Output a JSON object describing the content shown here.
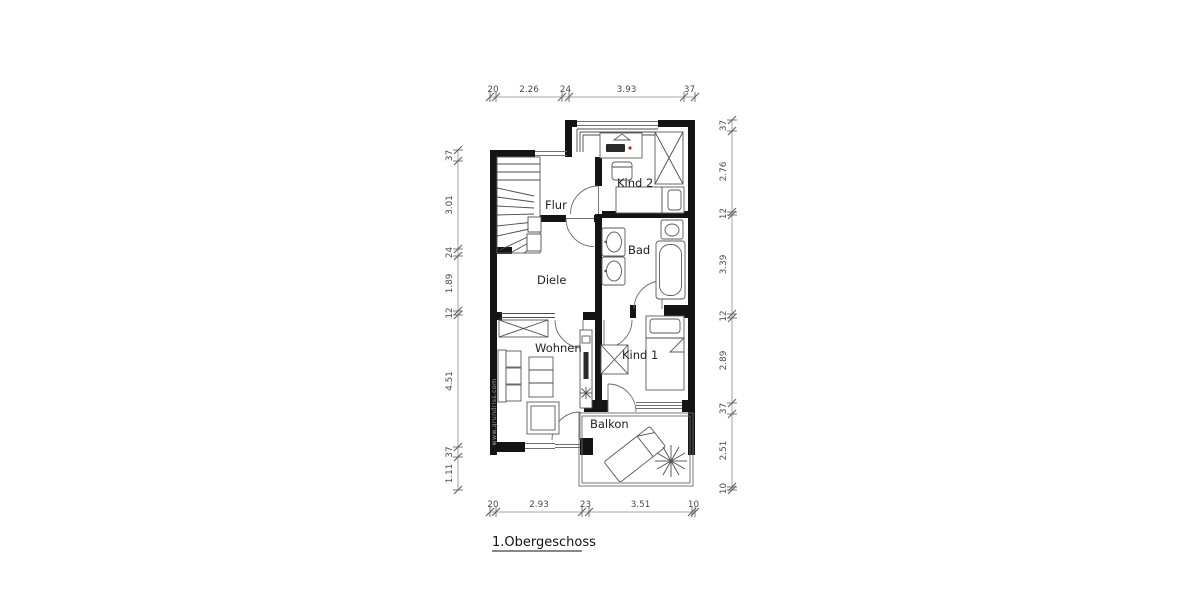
{
  "title": "1.Obergeschoss",
  "watermark": "www.grundriss.com",
  "rooms": {
    "kind2": "Kind 2",
    "flur": "Flur",
    "bad": "Bad",
    "diele": "Diele",
    "wohnen": "Wohnen",
    "kind1": "Kind 1",
    "balkon": "Balkon"
  },
  "dimensions": {
    "top": [
      "20",
      "2.26",
      "24",
      "3.93",
      "37"
    ],
    "bottom": [
      "20",
      "2.93",
      "23",
      "3.51",
      "10"
    ],
    "left": [
      "37",
      "3.01",
      "24",
      "1.89",
      "12",
      "4.51",
      "37",
      "1.11"
    ],
    "right": [
      "37",
      "2.76",
      "12",
      "3.39",
      "12",
      "2.89",
      "37",
      "2.51",
      "10"
    ]
  },
  "colors": {
    "background": "#ffffff",
    "wall": "#141414",
    "furniture_line": "#5a5a5a",
    "dimension_line": "#8a8a8a",
    "accent_dot": "#cc2222"
  }
}
